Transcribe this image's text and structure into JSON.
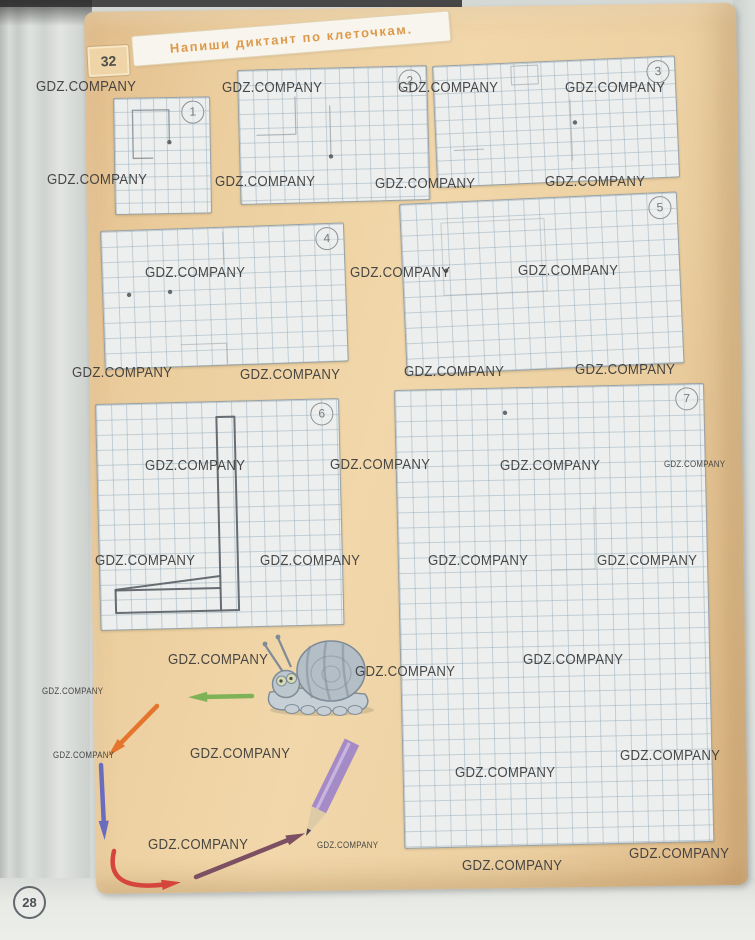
{
  "page": {
    "task_number": "32",
    "instruction": "Напиши диктант по клеточкам.",
    "page_number": "28"
  },
  "colors": {
    "accent_orange": "#dc9a4a",
    "watermark": "#3a3a3a",
    "pencil_ink": "#878e95",
    "dark_ink": "#60656b"
  },
  "watermark": {
    "text": "GDZ.COMPANY",
    "positions": [
      {
        "x": 36,
        "y": 78,
        "s": "L"
      },
      {
        "x": 222,
        "y": 79,
        "s": "L"
      },
      {
        "x": 398,
        "y": 79,
        "s": "L"
      },
      {
        "x": 565,
        "y": 79,
        "s": "L"
      },
      {
        "x": 47,
        "y": 171,
        "s": "L"
      },
      {
        "x": 215,
        "y": 173,
        "s": "L"
      },
      {
        "x": 375,
        "y": 175,
        "s": "L"
      },
      {
        "x": 545,
        "y": 173,
        "s": "L"
      },
      {
        "x": 145,
        "y": 264,
        "s": "L"
      },
      {
        "x": 350,
        "y": 264,
        "s": "L"
      },
      {
        "x": 518,
        "y": 262,
        "s": "L"
      },
      {
        "x": 72,
        "y": 364,
        "s": "L"
      },
      {
        "x": 240,
        "y": 366,
        "s": "L"
      },
      {
        "x": 404,
        "y": 363,
        "s": "L"
      },
      {
        "x": 575,
        "y": 361,
        "s": "L"
      },
      {
        "x": 145,
        "y": 457,
        "s": "L"
      },
      {
        "x": 330,
        "y": 456,
        "s": "L"
      },
      {
        "x": 500,
        "y": 457,
        "s": "L"
      },
      {
        "x": 664,
        "y": 459,
        "s": "S"
      },
      {
        "x": 95,
        "y": 552,
        "s": "L"
      },
      {
        "x": 260,
        "y": 552,
        "s": "L"
      },
      {
        "x": 428,
        "y": 552,
        "s": "L"
      },
      {
        "x": 597,
        "y": 552,
        "s": "L"
      },
      {
        "x": 168,
        "y": 651,
        "s": "L"
      },
      {
        "x": 355,
        "y": 663,
        "s": "L"
      },
      {
        "x": 523,
        "y": 651,
        "s": "L"
      },
      {
        "x": 42,
        "y": 686,
        "s": "S"
      },
      {
        "x": 53,
        "y": 750,
        "s": "S"
      },
      {
        "x": 190,
        "y": 745,
        "s": "L"
      },
      {
        "x": 620,
        "y": 747,
        "s": "L"
      },
      {
        "x": 455,
        "y": 764,
        "s": "L"
      },
      {
        "x": 148,
        "y": 836,
        "s": "L"
      },
      {
        "x": 317,
        "y": 840,
        "s": "S"
      },
      {
        "x": 629,
        "y": 845,
        "s": "L"
      },
      {
        "x": 462,
        "y": 857,
        "s": "L"
      }
    ]
  },
  "grids": [
    {
      "number": "1",
      "x": 113,
      "y": 98,
      "w": 95,
      "h": 115,
      "cell": 13,
      "rot": -1,
      "ink": "#878e95",
      "ink_width": 1.3,
      "opacity": 0.9,
      "strokes": [
        [
          [
            1.4,
            0.9
          ],
          [
            4.2,
            0.9
          ],
          [
            4.2,
            3.4
          ]
        ],
        [
          [
            1.4,
            0.9
          ],
          [
            1.4,
            4.6
          ],
          [
            2.9,
            4.6
          ]
        ]
      ],
      "dots": [
        [
          4.2,
          3.4
        ]
      ]
    },
    {
      "number": "2",
      "x": 237,
      "y": 70,
      "w": 188,
      "h": 133,
      "cell": 14.4,
      "rot": -1.5,
      "ink": "#99a0a7",
      "ink_width": 1.2,
      "opacity": 0.75,
      "strokes": [
        [
          [
            3.9,
            1.9
          ],
          [
            3.9,
            4.5
          ],
          [
            1.2,
            4.5
          ]
        ],
        [
          [
            6.3,
            2.6
          ],
          [
            6.3,
            6.1
          ]
        ]
      ],
      "dots": [
        [
          6.3,
          6.1
        ]
      ]
    },
    {
      "number": "3",
      "x": 432,
      "y": 66,
      "w": 241,
      "h": 120,
      "cell": 13.4,
      "rot": -2.5,
      "ink": "#9aa1a8",
      "ink_width": 1.1,
      "opacity": 0.6,
      "strokes": [
        [
          [
            5.8,
            0.2
          ],
          [
            7.8,
            0.2
          ],
          [
            7.8,
            1.6
          ],
          [
            5.8,
            1.6
          ],
          [
            5.8,
            0.2
          ]
        ],
        [
          [
            10.1,
            2.9
          ],
          [
            10.1,
            7.4
          ]
        ],
        [
          [
            1.3,
            6.3
          ],
          [
            3.5,
            6.3
          ]
        ]
      ],
      "dots": [
        [
          10.4,
          4.6
        ]
      ]
    },
    {
      "number": "4",
      "x": 100,
      "y": 231,
      "w": 242,
      "h": 137,
      "cell": 15.2,
      "rot": -2,
      "ink": "#9aa1a8",
      "ink_width": 1.1,
      "opacity": 0.55,
      "strokes": [
        [
          [
            8,
            0.3
          ],
          [
            8,
            2.4
          ]
        ],
        [
          [
            5,
            7.6
          ],
          [
            8,
            7.6
          ],
          [
            8,
            8.9
          ]
        ]
      ],
      "dots": [
        [
          1.7,
          4.2
        ],
        [
          4.4,
          4.1
        ]
      ]
    },
    {
      "number": "5",
      "x": 399,
      "y": 204,
      "w": 276,
      "h": 170,
      "cell": 15.4,
      "rot": -2.6,
      "ink": "#9aa1a8",
      "ink_width": 1.1,
      "opacity": 0.4,
      "strokes": [
        [
          [
            2.6,
            1.3
          ],
          [
            9.3,
            1.3
          ],
          [
            9.3,
            6
          ],
          [
            2.6,
            6
          ],
          [
            2.6,
            1.3
          ]
        ]
      ],
      "dots": [
        [
          2.8,
          4.4
        ]
      ]
    },
    {
      "number": "6",
      "x": 95,
      "y": 404,
      "w": 242,
      "h": 225,
      "cell": 15,
      "rot": -1.4,
      "ink": "#60656b",
      "ink_width": 2,
      "opacity": 0.95,
      "strokes": [
        [
          [
            8,
            1
          ],
          [
            9.2,
            1
          ],
          [
            9.2,
            13.9
          ],
          [
            8,
            13.9
          ],
          [
            8,
            1
          ]
        ],
        [
          [
            1,
            12.4
          ],
          [
            8,
            12.4
          ]
        ],
        [
          [
            1,
            12.4
          ],
          [
            1,
            13.9
          ],
          [
            8,
            13.9
          ]
        ],
        [
          [
            1,
            12.35
          ],
          [
            8,
            11.6
          ]
        ]
      ],
      "dots": []
    },
    {
      "number": "7",
      "x": 394,
      "y": 390,
      "w": 308,
      "h": 457,
      "cell": 15.2,
      "rot": -1.3,
      "ink": "#9aa1a8",
      "ink_width": 1.1,
      "opacity": 0.45,
      "strokes": [
        [
          [
            12.9,
            7.9
          ],
          [
            12.9,
            12
          ]
        ],
        [
          [
            10.1,
            12
          ],
          [
            12.9,
            12
          ]
        ]
      ],
      "dots": [
        [
          7.2,
          1.6
        ]
      ]
    }
  ],
  "figures": {
    "snail": {
      "shell": "#b3bec7",
      "shell_line": "#7f8c98",
      "body": "#c6cfd5",
      "head": "#bcc6cd",
      "eye": "#d6dab4",
      "pupil": "#4c5146"
    },
    "arrows": [
      {
        "name": "green-arrow",
        "color": "#7eb257",
        "x1": 252,
        "y1": 696,
        "x2": 201,
        "y2": 697
      },
      {
        "name": "orange-arrow",
        "color": "#e4752d",
        "x1": 157,
        "y1": 706,
        "x2": 117,
        "y2": 747
      },
      {
        "name": "violet-arrow",
        "color": "#6a6cbd",
        "x1": 101,
        "y1": 765,
        "x2": 104,
        "y2": 827
      },
      {
        "name": "red-curved-arrow",
        "color": "#d6453c",
        "x1": 114,
        "y1": 851,
        "cx": 104,
        "cy": 893,
        "x2": 168,
        "y2": 884
      },
      {
        "name": "maroon-arrow",
        "color": "#7c4f62",
        "x1": 196,
        "y1": 877,
        "x2": 293,
        "y2": 838
      }
    ],
    "pencil": {
      "body": "#a58bc6",
      "stripe": "#c9b5e0",
      "wood": "#ddcba8",
      "lead": "#54455c",
      "x1": 352,
      "y1": 742,
      "x2": 306,
      "y2": 836,
      "width": 16
    }
  }
}
